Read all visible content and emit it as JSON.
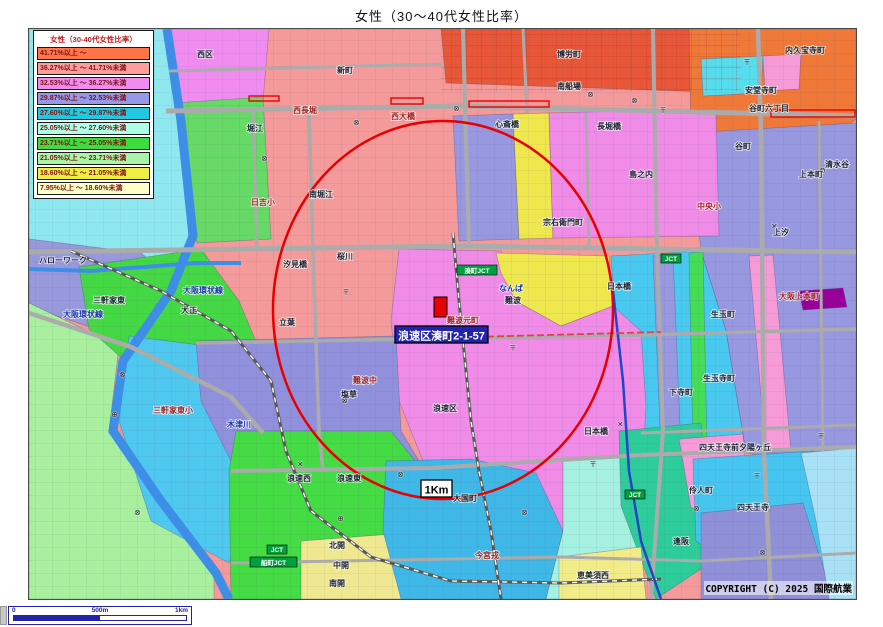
{
  "title": "女性（30〜40代女性比率）",
  "legend": {
    "title": "女性（30-40代女性比率）",
    "items": [
      {
        "label": "41.71%以上 ～",
        "color": "#FF7448"
      },
      {
        "label": "36.27%以上 ～ 41.71%未満",
        "color": "#FF9C9C"
      },
      {
        "label": "32.53%以上 ～ 36.27%未満",
        "color": "#F08CF0"
      },
      {
        "label": "29.87%以上 ～ 32.53%未満",
        "color": "#9898E8"
      },
      {
        "label": "27.60%以上 ～ 29.87%未満",
        "color": "#22C8E0"
      },
      {
        "label": "25.05%以上 ～ 27.60%未満",
        "color": "#ADFFE6"
      },
      {
        "label": "23.71%以上 ～ 25.05%未満",
        "color": "#3FDC3F"
      },
      {
        "label": "21.05%以上 ～ 23.71%未満",
        "color": "#A8F5A8"
      },
      {
        "label": "18.60%以上 ～ 21.05%未満",
        "color": "#EEEE44"
      },
      {
        "label": "7.95%以上 ～ 18.60%未満",
        "color": "#FFFFC8"
      }
    ]
  },
  "scalebar": {
    "left": "0",
    "mid": "500m",
    "right": "1km"
  },
  "copyright": "COPYRIGHT (C) 2025 国際航業",
  "map": {
    "address_label": "浪速区湊町2-1-57",
    "radius_label": "1Km",
    "palette": {
      "base": "#F59A9A",
      "road": "#ABABAB",
      "rail": "#585858",
      "river": "#3E8EE8",
      "red": "#E80000",
      "jct_green": "#00A040",
      "addr_bg": "#2222AE",
      "expressway": "#2244CC"
    },
    "regions": [
      {
        "name": "base",
        "fill": "#F59A9A",
        "pts": "28,28 855,28 855,598 28,598"
      },
      {
        "name": "cyan-left",
        "fill": "#8FE8F0",
        "pts": "28,28 168,28 178,122 192,242 162,272 140,258 28,252"
      },
      {
        "name": "nishiku-pink",
        "fill": "#F08CF0",
        "pts": "168,28 268,28 262,100 196,112 174,98"
      },
      {
        "name": "green-left",
        "fill": "#66D966",
        "pts": "174,102 262,96 270,238 196,242 186,150"
      },
      {
        "name": "purple-band",
        "fill": "#9898DD",
        "pts": "28,238 140,252 238,332 206,364 28,306"
      },
      {
        "name": "lightgreen-bl",
        "fill": "#A8F0A0",
        "pts": "28,302 118,345 108,430 158,500 213,570 213,598 28,598"
      },
      {
        "name": "green-sankenya",
        "fill": "#44D944",
        "pts": "78,266 200,248 238,300 258,348 250,400 160,392 88,328"
      },
      {
        "name": "cyan-taisho",
        "fill": "#4FC8F0",
        "pts": "128,335 262,352 255,472 228,562 150,520 118,420"
      },
      {
        "name": "top-darkred",
        "fill": "#E85838",
        "pts": "440,28 740,28 738,92 445,82"
      },
      {
        "name": "topright-orange",
        "fill": "#F07838",
        "pts": "688,28 855,28 855,118 838,132 745,138 732,205 700,198 690,135"
      },
      {
        "name": "tr-cyan-patch",
        "fill": "#55DDEE",
        "pts": "700,58 762,55 760,92 702,95"
      },
      {
        "name": "tr-pink-patch",
        "fill": "#F79AD8",
        "pts": "762,55 800,53 798,88 764,90"
      },
      {
        "name": "right-purple",
        "fill": "#9898E0",
        "pts": "688,132 855,122 855,452 800,462 745,452 725,330 700,250"
      },
      {
        "name": "purple-strip-mid",
        "fill": "#9898E0",
        "pts": "452,115 512,113 518,238 458,240"
      },
      {
        "name": "yellow-shinsaibashi",
        "fill": "#EEE84E",
        "pts": "512,113 548,112 552,237 518,238"
      },
      {
        "name": "magenta-shimanouchi",
        "fill": "#F08CE8",
        "pts": "548,112 715,108 718,235 552,237"
      },
      {
        "name": "rightcol-cyan",
        "fill": "#49C9F0",
        "pts": "610,255 700,250 725,330 745,452 640,460 615,330"
      },
      {
        "name": "green-strip-right",
        "fill": "#44DD55",
        "pts": "688,252 702,251 706,445 692,446"
      },
      {
        "name": "purple-strip-right",
        "fill": "#9898E0",
        "pts": "652,255 672,254 680,450 660,452"
      },
      {
        "name": "pink-strip-right",
        "fill": "#F79AD8",
        "pts": "748,255 772,254 790,450 765,452"
      },
      {
        "name": "darkmagenta-uehonmachi",
        "fill": "#990099",
        "pts": "798,290 842,287 846,306 802,309"
      },
      {
        "name": "center-magenta",
        "fill": "#F08CE8",
        "pts": "398,248 500,250 515,300 560,325 612,305 640,330 645,405 640,500 560,540 470,542 430,480 398,400 390,320"
      },
      {
        "name": "yellow-namba",
        "fill": "#EEE84E",
        "pts": "495,252 608,255 612,305 560,325 515,300 500,272"
      },
      {
        "name": "centerleft-purple",
        "fill": "#9090DD",
        "pts": "195,340 395,335 400,430 430,480 430,530 350,540 235,470 200,400"
      },
      {
        "name": "green-naniwa",
        "fill": "#44DB44",
        "pts": "235,430 390,430 430,480 430,540 350,598 230,598 228,470"
      },
      {
        "name": "yellow-kai",
        "fill": "#F0E890",
        "pts": "300,540 405,532 462,578 462,598 300,598"
      },
      {
        "name": "blue-imamiya",
        "fill": "#3FB8E8",
        "pts": "385,460 470,458 535,472 562,530 545,598 400,598 382,530"
      },
      {
        "name": "palecyan-daikoku",
        "fill": "#A5F0E0",
        "pts": "562,460 645,452 662,532 625,598 545,598 562,530"
      },
      {
        "name": "teal-osaka",
        "fill": "#2ECC9A",
        "pts": "618,430 700,422 712,560 655,598 620,505"
      },
      {
        "name": "pink-reinincho",
        "fill": "#F79AD8",
        "pts": "678,438 742,433 748,502 690,507"
      },
      {
        "name": "cyan-shitennoji",
        "fill": "#45C5F0",
        "pts": "692,458 812,450 832,562 742,572 695,540"
      },
      {
        "name": "purple-br",
        "fill": "#9090D8",
        "pts": "700,512 802,502 832,598 700,598"
      },
      {
        "name": "paleblue-right-edge",
        "fill": "#A8E0F5",
        "pts": "800,452 855,447 855,598 828,598 815,520"
      },
      {
        "name": "yellow-ebisu",
        "fill": "#F2EC88",
        "pts": "558,556 640,546 645,598 558,598"
      }
    ],
    "roads": [
      {
        "pts": "165,110 460,105 855,115",
        "w": 5
      },
      {
        "pts": "28,251 460,245 855,251",
        "w": 5
      },
      {
        "pts": "308,108 312,250 318,430 322,470",
        "w": 3.5
      },
      {
        "pts": "252,108 256,250",
        "w": 3
      },
      {
        "pts": "462,28 468,246",
        "w": 4
      },
      {
        "pts": "522,28 526,112",
        "w": 3
      },
      {
        "pts": "585,112 588,248",
        "w": 3
      },
      {
        "pts": "652,28 656,250 662,430 650,598",
        "w": 4
      },
      {
        "pts": "757,28 760,130 763,452 770,598",
        "w": 4.5
      },
      {
        "pts": "818,120 822,450",
        "w": 3
      },
      {
        "pts": "195,342 640,334 855,328",
        "w": 3.5
      },
      {
        "pts": "230,470 430,467 640,454 855,446",
        "w": 4
      },
      {
        "pts": "28,312 130,346 230,396 262,432",
        "w": 4.5
      },
      {
        "pts": "640,432 855,424",
        "w": 3
      },
      {
        "pts": "230,562 560,556 700,560 855,552",
        "w": 3
      },
      {
        "pts": "168,70 440,63",
        "w": 3
      }
    ],
    "rails": [
      {
        "pts": "70,250 160,290 230,330 270,380 285,450 310,510 370,556 450,580 560,582 660,578"
      },
      {
        "pts": "452,232 458,300 462,340 470,420 478,470 490,530 500,598"
      }
    ],
    "rivers": [
      {
        "pts": "166,28 180,120 192,235 170,290 122,360 112,430 160,500 215,572 228,598",
        "w": 9
      },
      {
        "pts": "28,268 90,270 195,262 240,262",
        "w": 4
      }
    ],
    "expressway": {
      "pts": "612,290 622,380 628,470 640,540 660,598"
    },
    "red_segments": [
      [
        390,
        97,
        32,
        6
      ],
      [
        468,
        100,
        80,
        6
      ],
      [
        770,
        109,
        84,
        7
      ],
      [
        248,
        95,
        30,
        5
      ]
    ],
    "red_dash": {
      "pts": "396,338 660,331"
    },
    "circle": {
      "cx": 442,
      "cy": 309,
      "rx": 170,
      "ry": 189
    },
    "marker": {
      "x": 433,
      "y": 296,
      "w": 13,
      "h": 20
    },
    "symbols": [
      {
        "g": "⊗",
        "x": 352,
        "y": 124
      },
      {
        "g": "⊗",
        "x": 630,
        "y": 102
      },
      {
        "g": "⊗",
        "x": 452,
        "y": 110
      },
      {
        "g": "⊗",
        "x": 260,
        "y": 160
      },
      {
        "g": "⊗",
        "x": 340,
        "y": 402
      },
      {
        "g": "⊗",
        "x": 396,
        "y": 476
      },
      {
        "g": "⊗",
        "x": 520,
        "y": 514
      },
      {
        "g": "⊗",
        "x": 692,
        "y": 510
      },
      {
        "g": "⊗",
        "x": 758,
        "y": 554
      },
      {
        "g": "⊗",
        "x": 818,
        "y": 172
      },
      {
        "g": "⊗",
        "x": 133,
        "y": 514
      },
      {
        "g": "⊗",
        "x": 118,
        "y": 376
      },
      {
        "g": "⊗",
        "x": 586,
        "y": 96
      },
      {
        "g": "〒",
        "x": 341,
        "y": 294
      },
      {
        "g": "〒",
        "x": 508,
        "y": 350
      },
      {
        "g": "〒",
        "x": 752,
        "y": 478
      },
      {
        "g": "〒",
        "x": 816,
        "y": 438
      },
      {
        "g": "〒",
        "x": 658,
        "y": 112
      },
      {
        "g": "〒",
        "x": 742,
        "y": 64
      },
      {
        "g": "〒",
        "x": 588,
        "y": 466
      },
      {
        "g": "⊕",
        "x": 336,
        "y": 520
      },
      {
        "g": "⊕",
        "x": 110,
        "y": 416
      },
      {
        "g": "✕",
        "x": 296,
        "y": 466
      },
      {
        "g": "✕",
        "x": 616,
        "y": 426
      },
      {
        "g": "✕",
        "x": 770,
        "y": 228
      }
    ],
    "labels": [
      {
        "t": "西区",
        "x": 196,
        "y": 56,
        "c": "p"
      },
      {
        "t": "新町",
        "x": 336,
        "y": 72,
        "c": "p"
      },
      {
        "t": "西長堀",
        "x": 292,
        "y": 112,
        "c": "r"
      },
      {
        "t": "堀江",
        "x": 246,
        "y": 130,
        "c": "p"
      },
      {
        "t": "西大橋",
        "x": 390,
        "y": 118,
        "c": "r"
      },
      {
        "t": "日吉小",
        "x": 250,
        "y": 204,
        "c": "r"
      },
      {
        "t": "南堀江",
        "x": 308,
        "y": 196,
        "c": "p"
      },
      {
        "t": "南船場",
        "x": 556,
        "y": 88,
        "c": "p"
      },
      {
        "t": "博労町",
        "x": 556,
        "y": 56,
        "c": "p"
      },
      {
        "t": "心斎橋",
        "x": 494,
        "y": 126,
        "c": "p"
      },
      {
        "t": "長堀橋",
        "x": 596,
        "y": 128,
        "c": "p"
      },
      {
        "t": "島之内",
        "x": 628,
        "y": 176,
        "c": "p"
      },
      {
        "t": "宗右衛門町",
        "x": 542,
        "y": 224,
        "c": "p"
      },
      {
        "t": "内久宝寺町",
        "x": 784,
        "y": 52,
        "c": "p"
      },
      {
        "t": "安堂寺町",
        "x": 744,
        "y": 92,
        "c": "p"
      },
      {
        "t": "谷町六丁目",
        "x": 748,
        "y": 110,
        "c": "p"
      },
      {
        "t": "谷町",
        "x": 734,
        "y": 148,
        "c": "p"
      },
      {
        "t": "上本町",
        "x": 798,
        "y": 176,
        "c": "p"
      },
      {
        "t": "中央小",
        "x": 696,
        "y": 208,
        "c": "r"
      },
      {
        "t": "清水谷",
        "x": 824,
        "y": 166,
        "c": "p"
      },
      {
        "t": "上汐",
        "x": 772,
        "y": 234,
        "c": "p"
      },
      {
        "t": "ハローワーク",
        "x": 38,
        "y": 262,
        "c": "p"
      },
      {
        "t": "桜川",
        "x": 336,
        "y": 258,
        "c": "p"
      },
      {
        "t": "汐見橋",
        "x": 282,
        "y": 266,
        "c": "p"
      },
      {
        "t": "立葉",
        "x": 278,
        "y": 324,
        "c": "p"
      },
      {
        "t": "なんば",
        "x": 498,
        "y": 290,
        "c": "b"
      },
      {
        "t": "難波",
        "x": 504,
        "y": 302,
        "c": "p"
      },
      {
        "t": "難波元町",
        "x": 446,
        "y": 322,
        "c": "r"
      },
      {
        "t": "日本橋",
        "x": 606,
        "y": 288,
        "c": "p"
      },
      {
        "t": "大阪上本町",
        "x": 778,
        "y": 298,
        "c": "r"
      },
      {
        "t": "生玉町",
        "x": 710,
        "y": 316,
        "c": "p"
      },
      {
        "t": "大正",
        "x": 180,
        "y": 312,
        "c": "p"
      },
      {
        "t": "三軒家東",
        "x": 92,
        "y": 302,
        "c": "p"
      },
      {
        "t": "大阪環状線",
        "x": 62,
        "y": 316,
        "c": "b"
      },
      {
        "t": "大阪環状線",
        "x": 182,
        "y": 292,
        "c": "b"
      },
      {
        "t": "難波中",
        "x": 352,
        "y": 382,
        "c": "r"
      },
      {
        "t": "塩草",
        "x": 340,
        "y": 396,
        "c": "p"
      },
      {
        "t": "浪速区",
        "x": 432,
        "y": 410,
        "c": "p"
      },
      {
        "t": "三軒家東小",
        "x": 152,
        "y": 412,
        "c": "r"
      },
      {
        "t": "木津川",
        "x": 226,
        "y": 426,
        "c": "b"
      },
      {
        "t": "生玉寺町",
        "x": 702,
        "y": 380,
        "c": "p"
      },
      {
        "t": "下寺町",
        "x": 668,
        "y": 394,
        "c": "p"
      },
      {
        "t": "日本橋",
        "x": 583,
        "y": 433,
        "c": "p"
      },
      {
        "t": "浪速西",
        "x": 286,
        "y": 480,
        "c": "p"
      },
      {
        "t": "浪速東",
        "x": 336,
        "y": 480,
        "c": "p"
      },
      {
        "t": "大国町",
        "x": 452,
        "y": 500,
        "c": "p"
      },
      {
        "t": "四天王寺前夕陽ヶ丘",
        "x": 698,
        "y": 449,
        "c": "p"
      },
      {
        "t": "伶人町",
        "x": 688,
        "y": 492,
        "c": "p"
      },
      {
        "t": "四天王寺",
        "x": 736,
        "y": 509,
        "c": "p"
      },
      {
        "t": "逢阪",
        "x": 672,
        "y": 543,
        "c": "p"
      },
      {
        "t": "今宮戎",
        "x": 474,
        "y": 557,
        "c": "r"
      },
      {
        "t": "北開",
        "x": 328,
        "y": 547,
        "c": "p"
      },
      {
        "t": "中開",
        "x": 332,
        "y": 567,
        "c": "p"
      },
      {
        "t": "南開",
        "x": 328,
        "y": 585,
        "c": "p"
      },
      {
        "t": "恵美須西",
        "x": 576,
        "y": 577,
        "c": "p"
      }
    ],
    "badges": [
      {
        "kind": "jct",
        "t": "湊町JCT",
        "x": 456,
        "y": 264,
        "w": 40,
        "h": 10
      },
      {
        "kind": "jct",
        "t": "JCT",
        "x": 660,
        "y": 253,
        "w": 20,
        "h": 9
      },
      {
        "kind": "jct",
        "t": "JCT",
        "x": 266,
        "y": 544,
        "w": 20,
        "h": 9
      },
      {
        "kind": "jct",
        "t": "船町JCT",
        "x": 249,
        "y": 556,
        "w": 47,
        "h": 10
      },
      {
        "kind": "jct",
        "t": "JCT",
        "x": 624,
        "y": 489,
        "w": 20,
        "h": 9
      },
      {
        "kind": "addr",
        "t": "浪速区湊町2-1-57",
        "x": 394,
        "y": 325,
        "w": 93,
        "h": 17
      },
      {
        "kind": "km",
        "t": "1Km",
        "x": 420,
        "y": 479,
        "w": 31,
        "h": 17
      }
    ]
  }
}
